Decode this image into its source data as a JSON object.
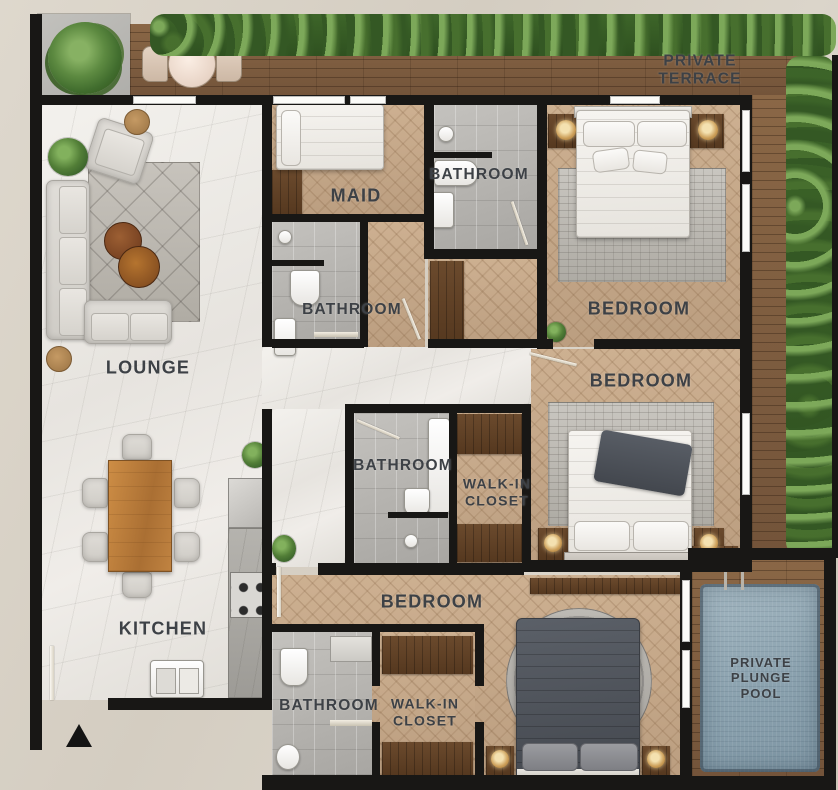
{
  "colors": {
    "bg": "#d9d3c8",
    "wall": "#181715",
    "label": "#3d4146",
    "deck_wood": "#7f5f41",
    "floor_wood": "#c4a786",
    "marble": "#eeece7",
    "tile": "#b4b2ae",
    "dark_wood": "#61412a",
    "pool_water": "#8da4b1",
    "plant_green": "#4e7b36",
    "rug_gray": "#b9b5af",
    "bed_white": "#f4f2ee",
    "duvet_dark": "#4d525a",
    "lamp_gold": "#c99e5c",
    "window": "#fbfbf8"
  },
  "labels": {
    "private_terrace": "PRIVATE TERRACE",
    "lounge": "LOUNGE",
    "kitchen": "KITCHEN",
    "maid": "MAID",
    "bathroom_maid_top": "BATHROOM",
    "bathroom_maid": "BATHROOM",
    "bedroom_top": "BEDROOM",
    "bedroom_middle": "BEDROOM",
    "bathroom_master": "BATHROOM",
    "walk_in_closet_master": "WALK-IN\nCLOSET",
    "bedroom_bottom": "BEDROOM",
    "bathroom_bottom": "BATHROOM",
    "walk_in_closet_bottom": "WALK-IN\nCLOSET",
    "plunge_pool": "PRIVATE\nPLUNGE\nPOOL"
  }
}
